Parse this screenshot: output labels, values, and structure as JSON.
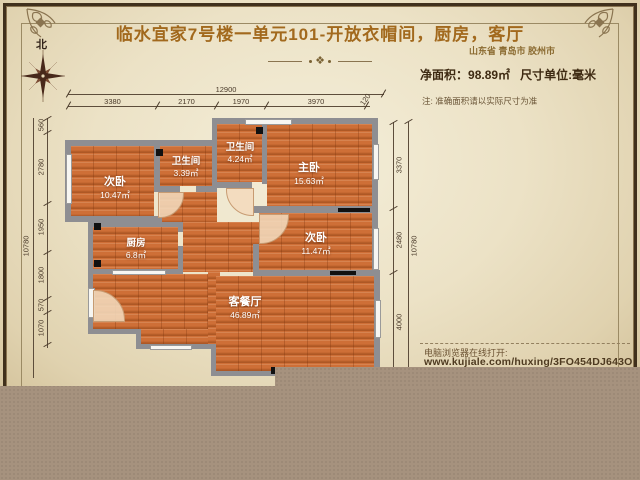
{
  "header": {
    "title": "临水宜家7号楼一单元101-开放衣帽间，厨房，客厅",
    "location": "山东省 青岛市 胶州市",
    "net_area_label": "净面积：",
    "net_area_value": "98.89㎡",
    "unit_label": "尺寸单位:毫米",
    "note": "注: 准确面积请以实际尺寸为准",
    "divider_icon": "❖"
  },
  "compass": {
    "north_label": "北"
  },
  "rooms": {
    "bedroom_tl": {
      "name": "次卧",
      "area": "10.47㎡"
    },
    "bath_small": {
      "name": "卫生间",
      "area": "3.39㎡"
    },
    "bath_top": {
      "name": "卫生间",
      "area": "4.24㎡"
    },
    "master": {
      "name": "主卧",
      "area": "15.63㎡"
    },
    "kitchen": {
      "name": "厨房",
      "area": "6.8㎡"
    },
    "bedroom_right": {
      "name": "次卧",
      "area": "11.47㎡"
    },
    "living": {
      "name": "客餐厅",
      "area": "46.89㎡"
    }
  },
  "dimensions": {
    "top_total": "12900",
    "top_segments": [
      "3380",
      "2170",
      "1970",
      "3970",
      "120"
    ],
    "left_total": "10780",
    "left_segments": [
      "560",
      "2780",
      "1950",
      "1800",
      "570",
      "1070"
    ],
    "right_total": "10780",
    "right_segments": [
      "3370",
      "2480",
      "4000"
    ]
  },
  "footer": {
    "open_hint": "电脑浏览器在线打开:",
    "url": "www.kujiale.com/huxing/3FO454DJ643O"
  },
  "colors": {
    "desktop": "#a6927e",
    "parchment": "#ece2c6",
    "frame": "#40301c",
    "title": "#a2691d",
    "wall": "#8e8e92",
    "floor": "#ce6f37",
    "label_text": "#ffffff"
  }
}
